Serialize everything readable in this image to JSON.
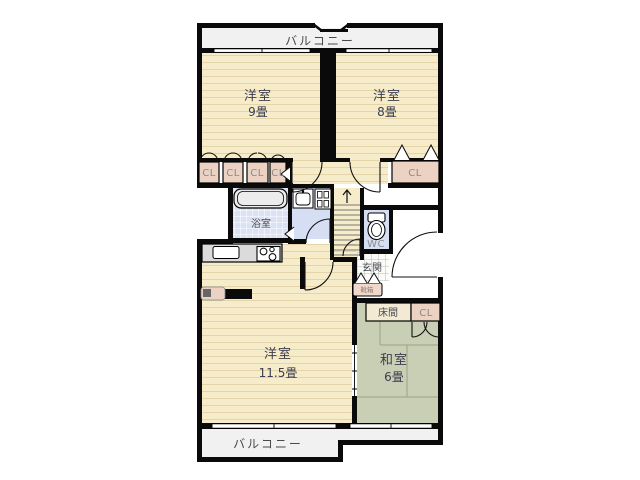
{
  "plan": {
    "balcony_top": "バルコニー",
    "balcony_bottom": "バルコニー",
    "bedroom9": {
      "name": "洋室",
      "size": "9畳"
    },
    "bedroom8": {
      "name": "洋室",
      "size": "8畳"
    },
    "living": {
      "name": "洋室",
      "size": "11.5畳"
    },
    "washitsu": {
      "name": "和室",
      "size": "6畳"
    },
    "bath": "浴室",
    "wc": "WC",
    "genkan": "玄関",
    "shoebox": "靴箱",
    "tokonoma": "床間",
    "closets_left": [
      "CL",
      "CL",
      "CL",
      "CL"
    ],
    "closet_right": "CL",
    "closet_washitsu": "CL"
  },
  "colors": {
    "wall": "#0a0a0a",
    "floor_cream": "#f7ecc9",
    "floor_line": "#e3d5a9",
    "balcony": "#f1f1f1",
    "closet": "#ebd2c2",
    "shoebox": "#f0d9cb",
    "bath_tile": "#dae2f3",
    "lavender": "#d6def4",
    "tatami": "#c9cfb5",
    "tatami_line": "#a3aa8c",
    "tokonoma": "#f3ead3",
    "counter": "#dbdbdb",
    "tub": "#ececec"
  }
}
